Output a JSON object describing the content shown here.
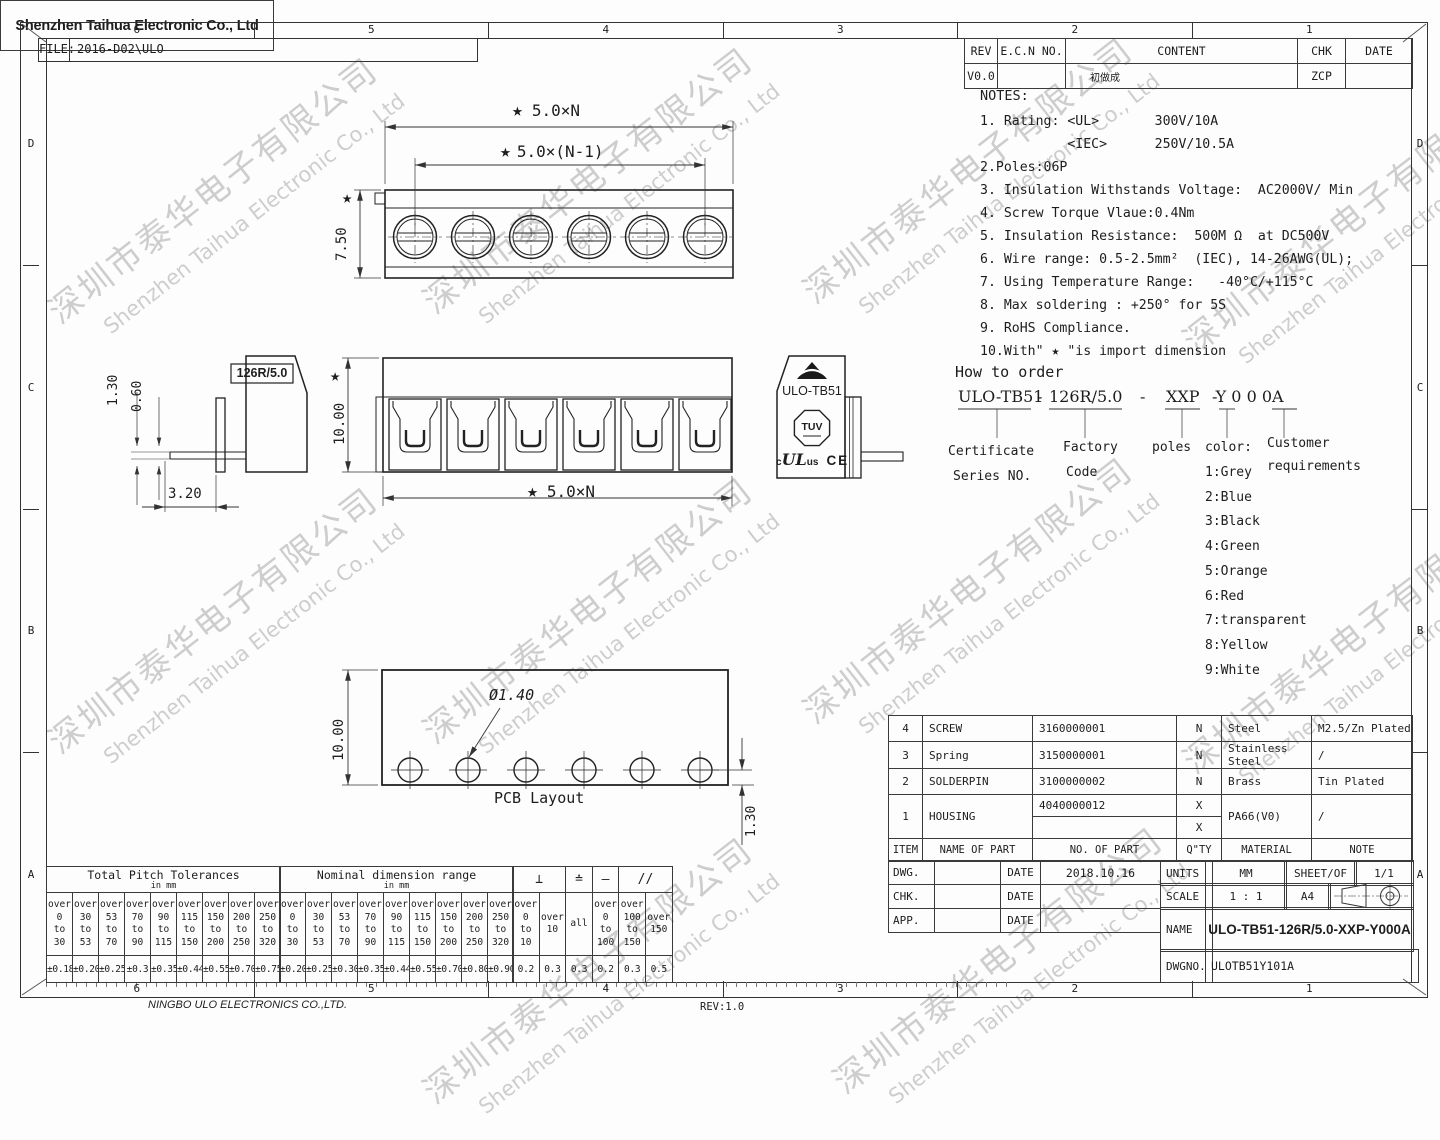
{
  "file": {
    "label": "FILE:",
    "value": "2016-D02\\ULO"
  },
  "zones": {
    "cols": [
      "6",
      "5",
      "4",
      "3",
      "2",
      "1"
    ],
    "rows": [
      "D",
      "C",
      "B",
      "A"
    ]
  },
  "footer": {
    "company": "NINGBO ULO ELECTRONICS CO.,LTD.",
    "rev": "REV:1.0"
  },
  "watermark": {
    "cn": "深圳市泰华电子有限公司",
    "en": "Shenzhen Taihua Electronic Co., Ltd"
  },
  "rev_table": {
    "headers": [
      "REV",
      "E.C.N NO.",
      "CONTENT",
      "CHK",
      "DATE"
    ],
    "row": [
      "V0.0",
      "",
      "初做成",
      "ZCP",
      ""
    ]
  },
  "notes": {
    "title": "NOTES:",
    "lines": [
      "1. Rating: <UL>       300V/10A",
      "           <IEC>      250V/10.5A",
      "2.Poles:06P",
      "3. Insulation Withstands Voltage:  AC2000V/ Min",
      "4. Screw Torque Vlaue:0.4Nm",
      "5. Insulation Resistance:  500M Ω  at DC500V",
      "6. Wire range: 0.5-2.5mm²  (IEC), 14-26AWG(UL);",
      "7. Using Temperature Range:   -40°C/+115°C",
      "8. Max soldering : +250° for 5S",
      "9. RoHS Compliance.",
      "10.With\" ★ \"is import dimension"
    ]
  },
  "order": {
    "heading": "How to order",
    "code": [
      "ULO-TB51",
      "-",
      "126R/5.0",
      "-",
      "XXP",
      "-Y 0 0 0A"
    ],
    "labels": {
      "cert1": "Certificate",
      "cert2": "Series NO.",
      "fact1": "Factory",
      "fact2": "Code",
      "poles": "poles",
      "color": "color:",
      "cust1": "Customer",
      "cust2": "requirements"
    },
    "colors": [
      "1:Grey",
      "2:Blue",
      "3:Black",
      "4:Green",
      "5:Orange",
      "6:Red",
      "7:transparent",
      "8:Yellow",
      "9:White"
    ]
  },
  "dims": {
    "star": "★",
    "top_overall": "5.0×N",
    "top_pitch": "5.0×(N-1)",
    "top_height": "7.50",
    "front_height": "10.00",
    "front_overall": "5.0×N",
    "side_label": "126R/5.0",
    "side_a": "1.30",
    "side_b": "0.60",
    "side_c": "3.20",
    "pcb_height": "10.00",
    "pcb_hole": "Ø1.40",
    "pcb_offset": "1.30",
    "pcb_caption": "PCB Layout",
    "brand": "ULO-TB51",
    "tuv": "TUV",
    "ul_prefix": "c",
    "ul": "UL",
    "ul_suffix": "us",
    "ce": "CE"
  },
  "parts": {
    "headers": [
      "ITEM",
      "NAME OF PART",
      "NO. OF PART",
      "Q\"TY",
      "MATERIAL",
      "NOTE"
    ],
    "rows": [
      [
        "4",
        "SCREW",
        "3160000001",
        "N",
        "Steel",
        "M2.5/Zn Plated"
      ],
      [
        "3",
        "Spring",
        "3150000001",
        "N",
        "Stainless Steel",
        "/"
      ],
      [
        "2",
        "SOLDERPIN",
        "3100000002",
        "N",
        "Brass",
        "Tin Plated"
      ]
    ],
    "housing": {
      "item": "1",
      "name": "HOUSING",
      "no1": "4040000012",
      "no2": "",
      "qty1": "X",
      "qty2": "X",
      "material": "PA66(V0)",
      "note": "/"
    }
  },
  "title_block": {
    "rows": [
      {
        "label": "DWG.",
        "date": "DATE",
        "value": "2018.10.16"
      },
      {
        "label": "CHK.",
        "date": "DATE",
        "value": ""
      },
      {
        "label": "APP.",
        "date": "DATE",
        "value": ""
      }
    ],
    "company": "Shenzhen Taihua Electronic Co., Ltd",
    "units_label": "UNITS",
    "units": "MM",
    "sheet_label": "SHEET/OF",
    "sheet": "1/1",
    "scale_label": "SCALE",
    "scale": "1 : 1",
    "paper": "A4",
    "name_label": "NAME",
    "name": "ULO-TB51-126R/5.0-XXP-Y000A",
    "dwgno_label": "DWGNO.",
    "dwgno": "ULOTB51Y101A"
  },
  "tolerances": {
    "pitch": {
      "title": "Total Pitch Tolerances",
      "unit": "in mm",
      "cells": [
        "over\n0\nto\n30",
        "over\n30\nto\n53",
        "over\n53\nto\n70",
        "over\n70\nto\n90",
        "over\n90\nto\n115",
        "over\n115\nto\n150",
        "over\n150\nto\n200",
        "over\n200\nto\n250",
        "over\n250\nto\n320"
      ],
      "values": [
        "±0.18",
        "±0.20",
        "±0.25",
        "±0.3",
        "±0.35",
        "±0.44",
        "±0.55",
        "±0.70",
        "±0.75"
      ]
    },
    "nominal": {
      "title": "Nominal dimension range",
      "unit": "in mm",
      "cells": [
        "over\n0\nto\n30",
        "over\n30\nto\n53",
        "over\n53\nto\n70",
        "over\n70\nto\n90",
        "over\n90\nto\n115",
        "over\n115\nto\n150",
        "over\n150\nto\n200",
        "over\n200\nto\n250",
        "over\n250\nto\n320"
      ],
      "values": [
        "±0.20",
        "±0.25",
        "±0.30",
        "±0.35",
        "±0.44",
        "±0.55",
        "±0.70",
        "±0.80",
        "±0.90"
      ]
    },
    "geo": {
      "symbols": [
        "⊥",
        "≐",
        "—",
        "//"
      ],
      "cells": [
        "over\n0\nto\n10",
        "over\n10",
        "all",
        "over\n0\nto\n100",
        "over\n100\nto\n150",
        "over\n150"
      ],
      "values": [
        "0.2",
        "0.3",
        "0.3",
        "0.2",
        "0.3",
        "0.5"
      ]
    }
  }
}
